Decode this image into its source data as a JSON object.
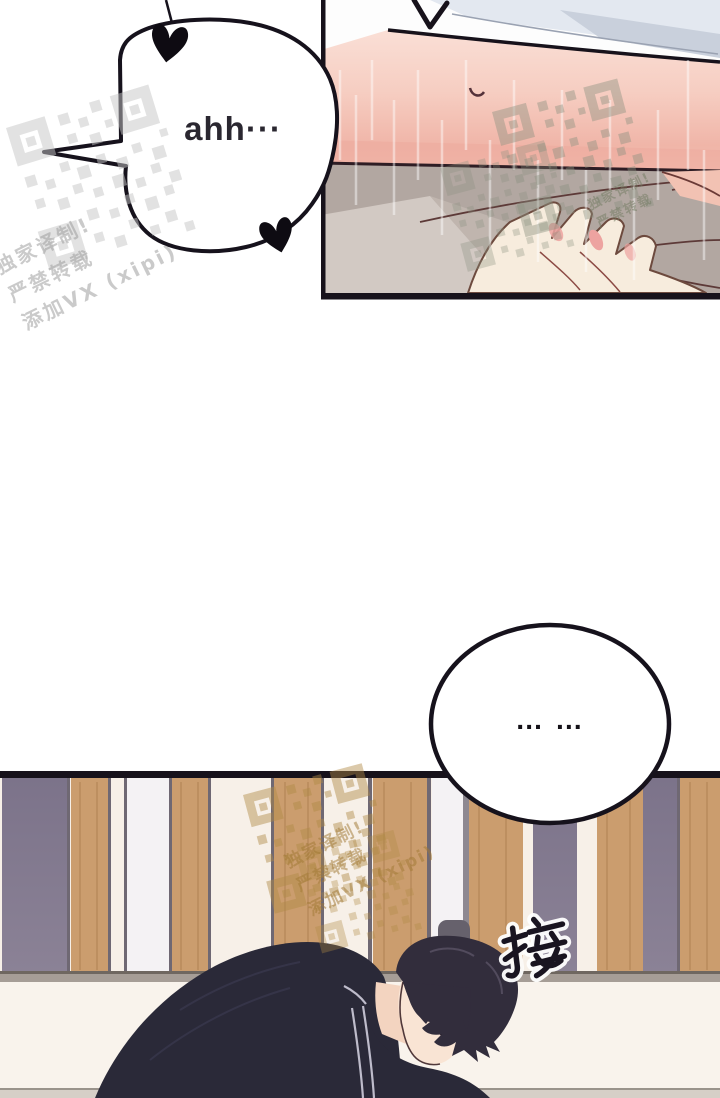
{
  "page": {
    "width": 720,
    "height": 1098,
    "background": "#ffffff",
    "kind": "comic page"
  },
  "speech": {
    "ahh": "ahh···",
    "pause": "… …"
  },
  "sfx": {
    "text": "接"
  },
  "watermark": {
    "lines": [
      "独家译制!",
      "严禁转载",
      "添加VX (xipi)"
    ]
  },
  "palette": {
    "ink": "#17121b",
    "bubble_fill": "#ffffff",
    "skin_deep_band": "#edaa9c",
    "fabric_shadow": "#e3e8f0",
    "fabric_shadow2": "#c9d0dc",
    "blanket_gray": "#b2a7a1",
    "blanket_light": "#d2c9c3",
    "blanket_mid": "#c3b9b2",
    "hand_skin": "#f7ecdd",
    "nail_pink": "#eda3a0",
    "side_pink": "#f2c2b3",
    "wall_cream": "#f7f0e8",
    "wood": "#cb9d6e",
    "stripe_purple": "#81788f",
    "stripe_white": "#f4f2f4",
    "stripe_line": "#6f6873",
    "baseboard": "#a69d96",
    "floor": "#f9f3ec",
    "bottom_strip": "#d6cfc7",
    "jacket_navy": "#2a2938",
    "hair_dark": "#322d3c",
    "face_skin": "#f9e4d4",
    "neck_skin": "#f3d4c0",
    "heart_black": "#0e0b12",
    "qr_gray": "#c6c6c6",
    "qr_green": "#8b9180",
    "qr_tan": "#b08a45"
  }
}
